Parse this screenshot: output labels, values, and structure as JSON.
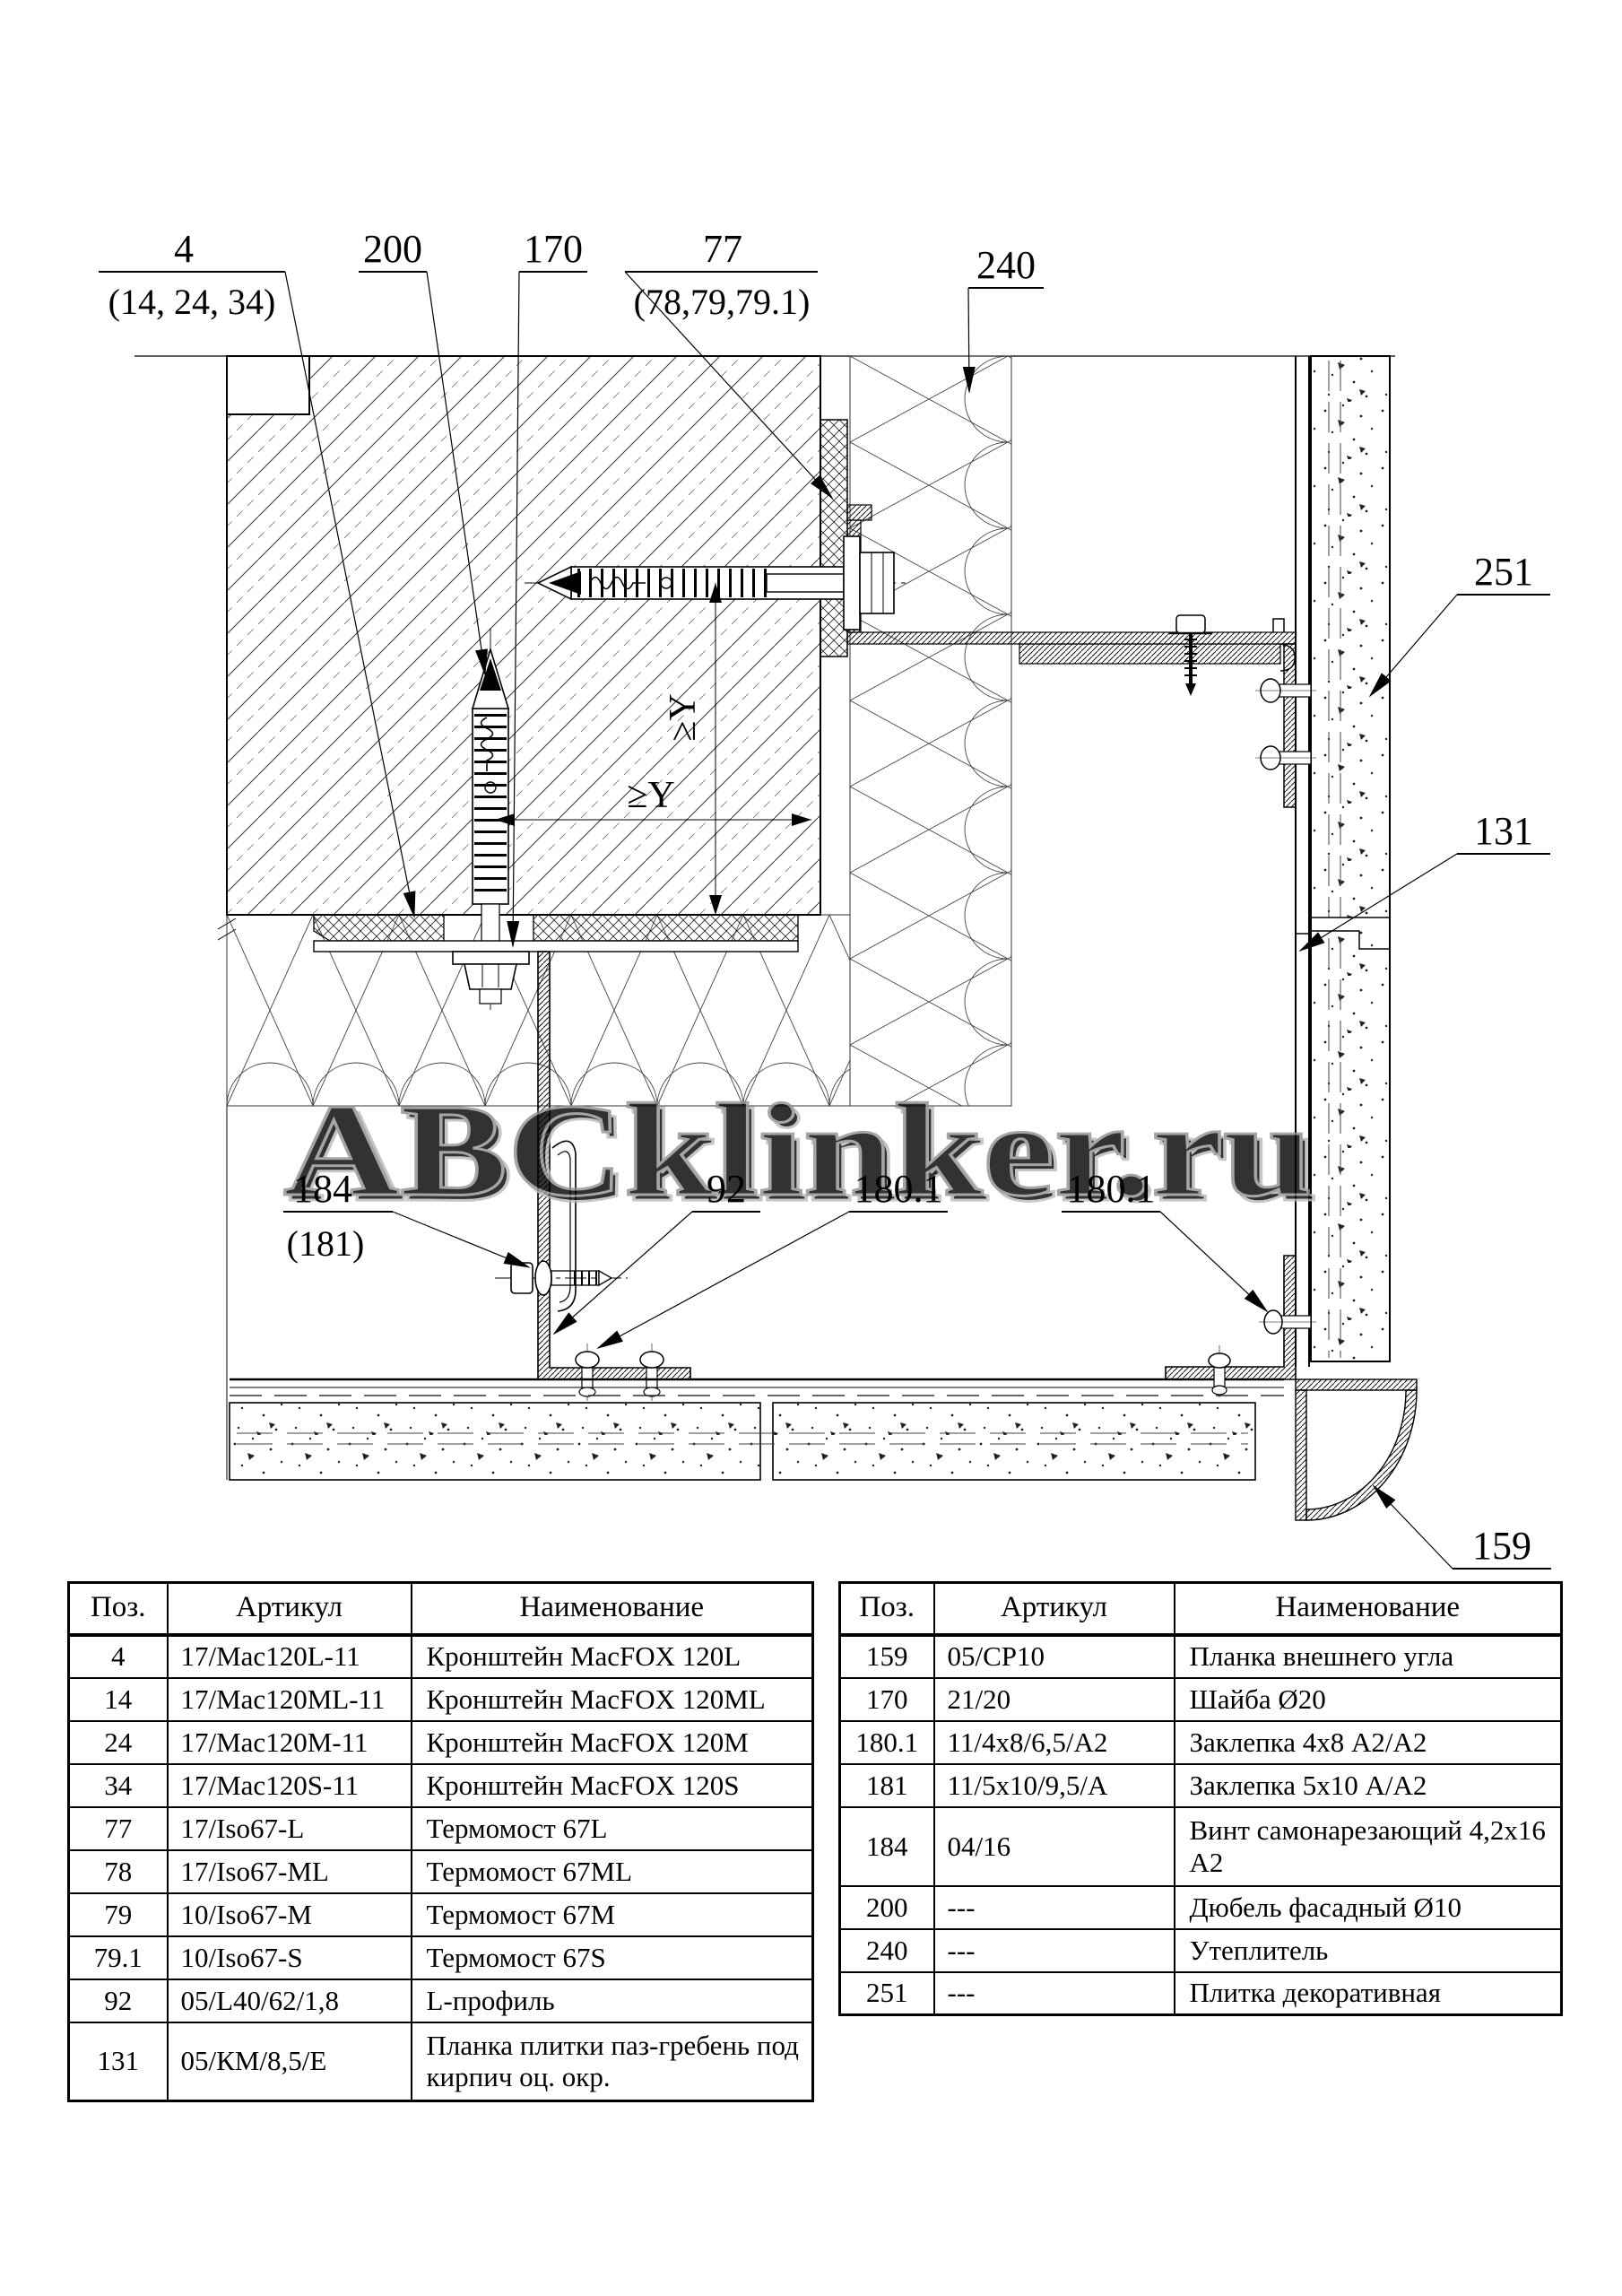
{
  "drawing": {
    "watermark": "ABCklinker.ru",
    "dim_horizontal": "≥Y",
    "dim_vertical": "≥Y",
    "callouts": {
      "c4": {
        "label": "4",
        "sub": "(14, 24, 34)"
      },
      "c200": {
        "label": "200"
      },
      "c170": {
        "label": "170"
      },
      "c77": {
        "label": "77",
        "sub": "(78,79,79.1)"
      },
      "c240": {
        "label": "240"
      },
      "c251": {
        "label": "251"
      },
      "c131": {
        "label": "131"
      },
      "c184": {
        "label": "184",
        "sub": "(181)"
      },
      "c92": {
        "label": "92"
      },
      "c180_1a": {
        "label": "180.1"
      },
      "c180_1b": {
        "label": "180.1"
      },
      "c159": {
        "label": "159"
      }
    }
  },
  "parts_table_left": {
    "headers": [
      "Поз.",
      "Артикул",
      "Наименование"
    ],
    "rows": [
      [
        "4",
        "17/Mac120L-11",
        "Кронштейн MacFOX 120L"
      ],
      [
        "14",
        "17/Mac120ML-11",
        "Кронштейн MacFOX 120ML"
      ],
      [
        "24",
        "17/Mac120M-11",
        "Кронштейн MacFOX 120M"
      ],
      [
        "34",
        "17/Mac120S-11",
        "Кронштейн MacFOX 120S"
      ],
      [
        "77",
        "17/Iso67-L",
        "Термомост 67L"
      ],
      [
        "78",
        "17/Iso67-ML",
        "Термомост 67ML"
      ],
      [
        "79",
        "10/Iso67-M",
        "Термомост 67M"
      ],
      [
        "79.1",
        "10/Iso67-S",
        "Термомост 67S"
      ],
      [
        "92",
        "05/L40/62/1,8",
        "L-профиль"
      ],
      [
        "131",
        "05/КМ/8,5/Е",
        "Планка плитки паз-гребень под кирпич оц. окр."
      ]
    ]
  },
  "parts_table_right": {
    "headers": [
      "Поз.",
      "Артикул",
      "Наименование"
    ],
    "rows": [
      [
        "159",
        "05/CP10",
        "Планка внешнего угла"
      ],
      [
        "170",
        "21/20",
        "Шайба Ø20"
      ],
      [
        "180.1",
        "11/4x8/6,5/А2",
        "Заклепка 4x8 А2/А2"
      ],
      [
        "181",
        "11/5x10/9,5/А",
        "Заклепка 5x10 А/А2"
      ],
      [
        "184",
        "04/16",
        "Винт самонарезающий 4,2x16 А2"
      ],
      [
        "200",
        "---",
        "Дюбель фасадный Ø10"
      ],
      [
        "240",
        "---",
        "Утеплитель"
      ],
      [
        "251",
        "---",
        "Плитка декоративная"
      ]
    ]
  }
}
